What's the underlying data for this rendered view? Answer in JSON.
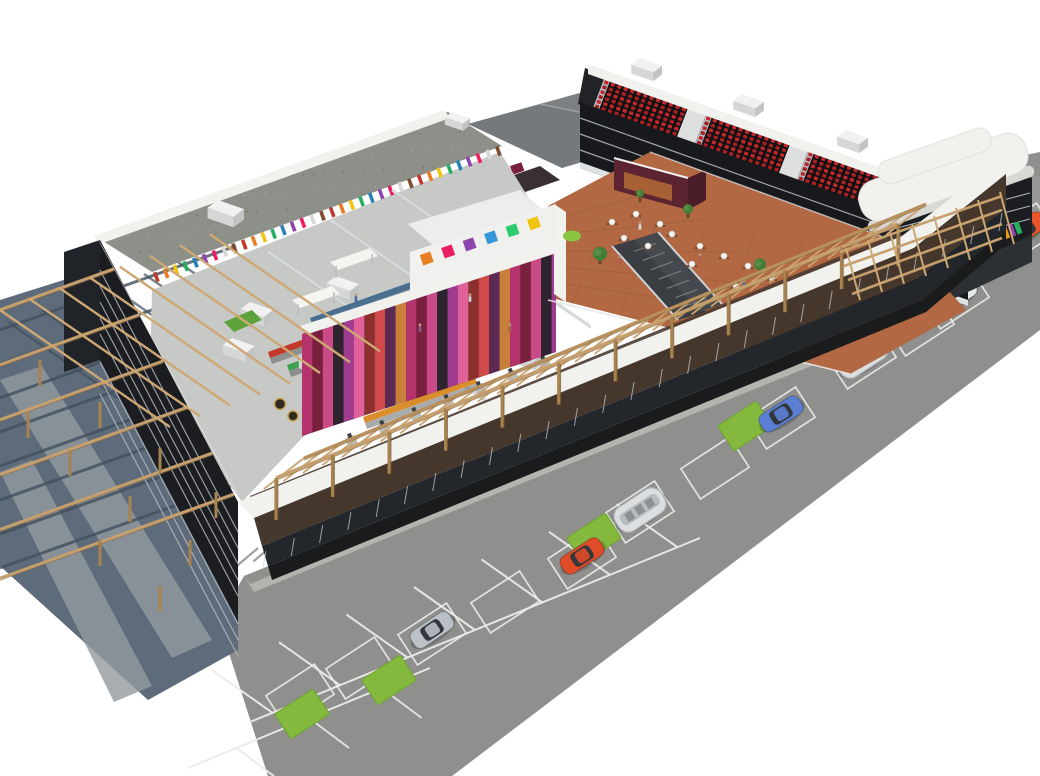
{
  "scene": {
    "type": "3d-architectural-render",
    "subject": "Isometric cutaway rendering of a shopping mall complex with rooftop-removed interior view, cinema auditoriums, supermarket, food-court terrace, wooden pergolas and surface parking lot on white background"
  },
  "palette": {
    "bg": "#ffffff",
    "asphalt": "#8f8f8d",
    "asphalt_light": "#9d9d9b",
    "sidewalk": "#b5b3ae",
    "plaza": "#5d6b7a",
    "plaza_walk": "#939aa0",
    "plaza_shadow": "#42505e",
    "grass": "#85b93e",
    "grass_dark": "#6da32f",
    "stall_line": "#ebebe9",
    "wood": "#c59f6d",
    "wood_dark": "#8a6a42",
    "facade_dark": "#1b1d20",
    "stripe_light": "#b9bec2",
    "parapet": "#f1f1ee",
    "parapet_shade": "#d8d8d4",
    "brown_band": "#45372c",
    "glass_band": "#23272b",
    "base_band": "#191b1d",
    "gravel": "#8d9088",
    "roof_pitched": "#7c8083",
    "roof_pitched_dark": "#6f7477",
    "terracotta": "#b26843",
    "market_floor": "#c7c9c7",
    "cinema_face": "#17191c",
    "cinema_interior": "#212327",
    "cinema_side": "#c9ced2",
    "seat_red": "#c3272b",
    "white_box": "#f0f1f0",
    "duct": "#d6dadc",
    "escalator": "#3a3e42",
    "rail_silver": "#cfd4d6",
    "tree_green": "#447c3a",
    "ottoman_green": "#8ac53f",
    "maroon": "#5c2430",
    "maroon_dark": "#4a1c27",
    "restaurant_glow": "#b36b35",
    "shadow": "#6e6e6c",
    "checkout": "#b9bcbd",
    "barrel": "#2e2a26",
    "barrel_ring": "#caa64a",
    "green_mat": "#5da33c"
  },
  "parking": {
    "cars": [
      {
        "x": 432,
        "y": 630,
        "a": -34,
        "color": "#b9c0c6",
        "name": "silver-sedan"
      },
      {
        "x": 582,
        "y": 556,
        "a": -33,
        "color": "#e04b28",
        "name": "red-hatchback"
      },
      {
        "x": 781,
        "y": 414,
        "a": -32,
        "color": "#5b7fd4",
        "name": "blue-hatchback"
      },
      {
        "x": 955,
        "y": 296,
        "a": -33,
        "color": "#e7e8e8",
        "name": "white-sedan"
      },
      {
        "x": 1024,
        "y": 230,
        "a": -33,
        "color": "#e8542c",
        "name": "orange-car"
      }
    ],
    "cart_shelters": [
      {
        "x": 640,
        "y": 510,
        "a": -33
      },
      {
        "x": 862,
        "y": 356,
        "a": -33
      }
    ],
    "grass_patches": [
      {
        "x": 389,
        "y": 680
      },
      {
        "x": 302,
        "y": 714
      },
      {
        "x": 594,
        "y": 538
      },
      {
        "x": 745,
        "y": 426
      },
      {
        "x": 941,
        "y": 290
      },
      {
        "x": 1012,
        "y": 232
      }
    ],
    "stalls": [
      {
        "x": 432,
        "y": 634,
        "a": -33
      },
      {
        "x": 505,
        "y": 602,
        "a": -33
      },
      {
        "x": 582,
        "y": 558,
        "a": -33
      },
      {
        "x": 640,
        "y": 512,
        "a": -33
      },
      {
        "x": 715,
        "y": 468,
        "a": -33
      },
      {
        "x": 781,
        "y": 418,
        "a": -33
      },
      {
        "x": 862,
        "y": 358,
        "a": -33
      },
      {
        "x": 920,
        "y": 325,
        "a": -33
      },
      {
        "x": 955,
        "y": 298,
        "a": -33
      },
      {
        "x": 1022,
        "y": 234,
        "a": -33
      },
      {
        "x": 300,
        "y": 695,
        "a": -33
      },
      {
        "x": 360,
        "y": 668,
        "a": -33
      }
    ],
    "row_lines": [
      {
        "x1": 250,
        "y1": 722,
        "x2": 700,
        "y2": 538
      },
      {
        "x1": 188,
        "y1": 768,
        "x2": 430,
        "y2": 668
      }
    ]
  },
  "cinema": {
    "auditorium_count": 3,
    "rows": 7,
    "seats_per_row": 13,
    "auditoriums": [
      {
        "ox": 604,
        "oy": 79
      },
      {
        "ox": 706,
        "oy": 115
      },
      {
        "ox": 808,
        "oy": 151
      }
    ],
    "hvac": [
      {
        "x": 640,
        "y": 58
      },
      {
        "x": 742,
        "y": 94
      },
      {
        "x": 846,
        "y": 130
      }
    ]
  },
  "supermarket": {
    "aisles": [
      {
        "x": 268,
        "y": 352,
        "c": "#c0392b"
      },
      {
        "x": 287,
        "y": 365,
        "c": "#3fa14d"
      },
      {
        "x": 306,
        "y": 378,
        "c": "#e0b52a"
      },
      {
        "x": 325,
        "y": 391,
        "c": "#3fa14d"
      },
      {
        "x": 344,
        "y": 404,
        "c": "#c0392b"
      },
      {
        "x": 363,
        "y": 417,
        "c": "#d98e2b"
      },
      {
        "x": 310,
        "y": 318,
        "c": "#4a6f8f"
      },
      {
        "x": 330,
        "y": 331,
        "c": "#c0392b"
      }
    ],
    "hvac_boxes": [
      {
        "x": 250,
        "y": 302
      },
      {
        "x": 336,
        "y": 276
      },
      {
        "x": 420,
        "y": 250
      },
      {
        "x": 308,
        "y": 352
      },
      {
        "x": 394,
        "y": 326
      },
      {
        "x": 478,
        "y": 300
      },
      {
        "x": 520,
        "y": 346
      },
      {
        "x": 232,
        "y": 338
      }
    ],
    "canopies": [
      {
        "x": 330,
        "y": 262
      },
      {
        "x": 292,
        "y": 300
      },
      {
        "x": 414,
        "y": 296
      },
      {
        "x": 372,
        "y": 332
      }
    ],
    "checkout_count": 7,
    "wall_stripe_colors": [
      "#c0392b",
      "#e67e22",
      "#f1c40f",
      "#27ae60",
      "#2980b9",
      "#8e44ad",
      "#e91e63",
      "#d7d7d4",
      "#7f4d2e"
    ]
  },
  "mall": {
    "poster_colors": [
      "#b4336a",
      "#7a1f3d",
      "#c94a86",
      "#2d2430",
      "#a03b8f",
      "#e0609a",
      "#8c2f2f",
      "#d14a4a",
      "#5b2a52",
      "#c77f3a"
    ],
    "kids_squares": [
      "#e67e22",
      "#e91e63",
      "#8e44ad",
      "#3498db",
      "#2ecc71",
      "#f1c40f"
    ],
    "window_strip_colors": [
      "#e74c3c",
      "#f39c12",
      "#8e44ad",
      "#27ae60",
      "#2980b9",
      "#e91e63",
      "#d35400",
      "#16a085"
    ],
    "tables": [
      [
        612,
        222
      ],
      [
        636,
        214
      ],
      [
        660,
        224
      ],
      [
        624,
        238
      ],
      [
        648,
        246
      ],
      [
        672,
        234
      ],
      [
        700,
        246
      ],
      [
        724,
        256
      ],
      [
        692,
        264
      ],
      [
        748,
        266
      ],
      [
        772,
        278
      ],
      [
        736,
        286
      ],
      [
        806,
        300
      ],
      [
        830,
        312
      ],
      [
        796,
        318
      ]
    ],
    "trees": [
      {
        "x": 600,
        "y": 258,
        "r": 7
      },
      {
        "x": 688,
        "y": 212,
        "r": 5
      },
      {
        "x": 760,
        "y": 268,
        "r": 6
      },
      {
        "x": 842,
        "y": 306,
        "r": 7
      },
      {
        "x": 884,
        "y": 272,
        "r": 5
      },
      {
        "x": 640,
        "y": 196,
        "r": 4
      }
    ],
    "ottoman": {
      "x": 572,
      "y": 236
    },
    "people": [
      [
        640,
        228
      ],
      [
        700,
        260
      ],
      [
        744,
        286
      ],
      [
        800,
        310
      ],
      [
        860,
        330
      ],
      [
        620,
        262
      ],
      [
        356,
        300
      ],
      [
        420,
        330
      ],
      [
        470,
        300
      ],
      [
        510,
        330
      ]
    ]
  },
  "pergola": {
    "front_posts": 12,
    "front_rafters": 32,
    "left_beams": 6,
    "left_rafters": 8
  }
}
